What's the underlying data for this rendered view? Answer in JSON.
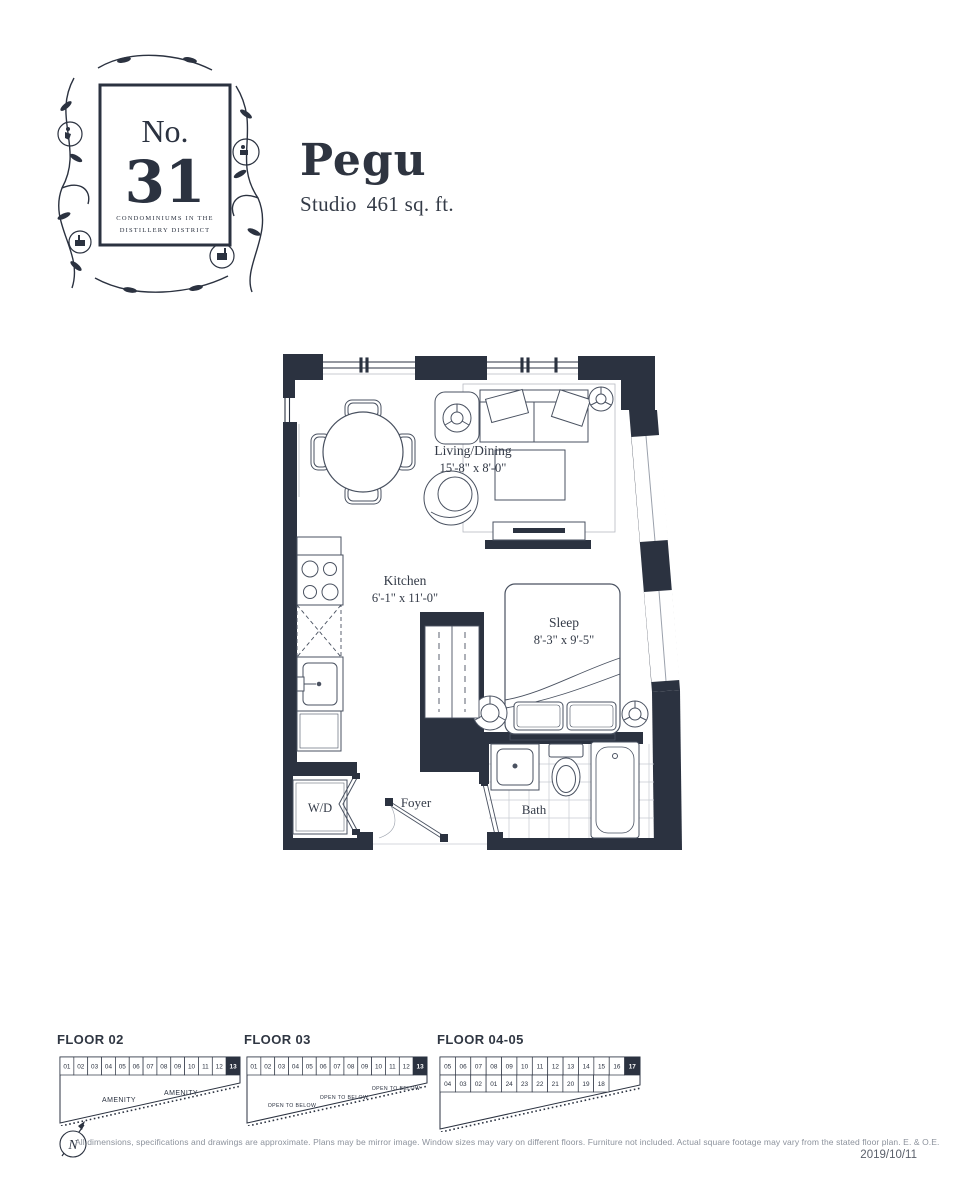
{
  "logo": {
    "prefix": "No.",
    "number": "31",
    "tagline1": "CONDOMINIUMS IN THE",
    "tagline2": "DISTILLERY DISTRICT"
  },
  "header": {
    "unit_name": "Pegu",
    "unit_type": "Studio",
    "unit_area": "461 sq. ft."
  },
  "floorplan": {
    "living_dining": {
      "name": "Living/Dining",
      "dims": "15'-8\" x 8'-0\""
    },
    "kitchen": {
      "name": "Kitchen",
      "dims": "6'-1\" x 11'-0\""
    },
    "sleep": {
      "name": "Sleep",
      "dims": "8'-3\" x 9'-5\""
    },
    "wd": {
      "name": "W/D"
    },
    "foyer": {
      "name": "Foyer"
    },
    "bath": {
      "name": "Bath"
    }
  },
  "keyplans": [
    {
      "label": "FLOOR 02",
      "top_units": [
        "01",
        "02",
        "03",
        "04",
        "05",
        "06",
        "07",
        "08",
        "09",
        "10",
        "11",
        "12",
        "13"
      ],
      "highlight_unit": "13",
      "area_labels": [
        "AMENITY",
        "AMENITY"
      ]
    },
    {
      "label": "FLOOR 03",
      "top_units": [
        "01",
        "02",
        "03",
        "04",
        "05",
        "06",
        "07",
        "08",
        "09",
        "10",
        "11",
        "12",
        "13"
      ],
      "highlight_unit": "13",
      "area_labels": [
        "OPEN TO BELOW",
        "OPEN TO BELOW",
        "OPEN TO BELOW"
      ]
    },
    {
      "label": "FLOOR 04-05",
      "top_units": [
        "05",
        "06",
        "07",
        "08",
        "09",
        "10",
        "11",
        "12",
        "13",
        "14",
        "15",
        "16",
        "17"
      ],
      "bottom_units": [
        "04",
        "03",
        "02",
        "01",
        "24",
        "23",
        "22",
        "21",
        "20",
        "19",
        "18"
      ],
      "highlight_unit": "17",
      "area_labels": []
    }
  ],
  "compass": {
    "label": "N"
  },
  "footer": {
    "disclaimer": "All dimensions, specifications and drawings are approximate. Plans may be mirror image. Window sizes may vary on different floors. Furniture not included. Actual square footage may vary from the stated floor plan. E. & O.E.",
    "date": "2019/10/11"
  },
  "colors": {
    "ink": "#2b3240",
    "muted": "#8c929c"
  }
}
